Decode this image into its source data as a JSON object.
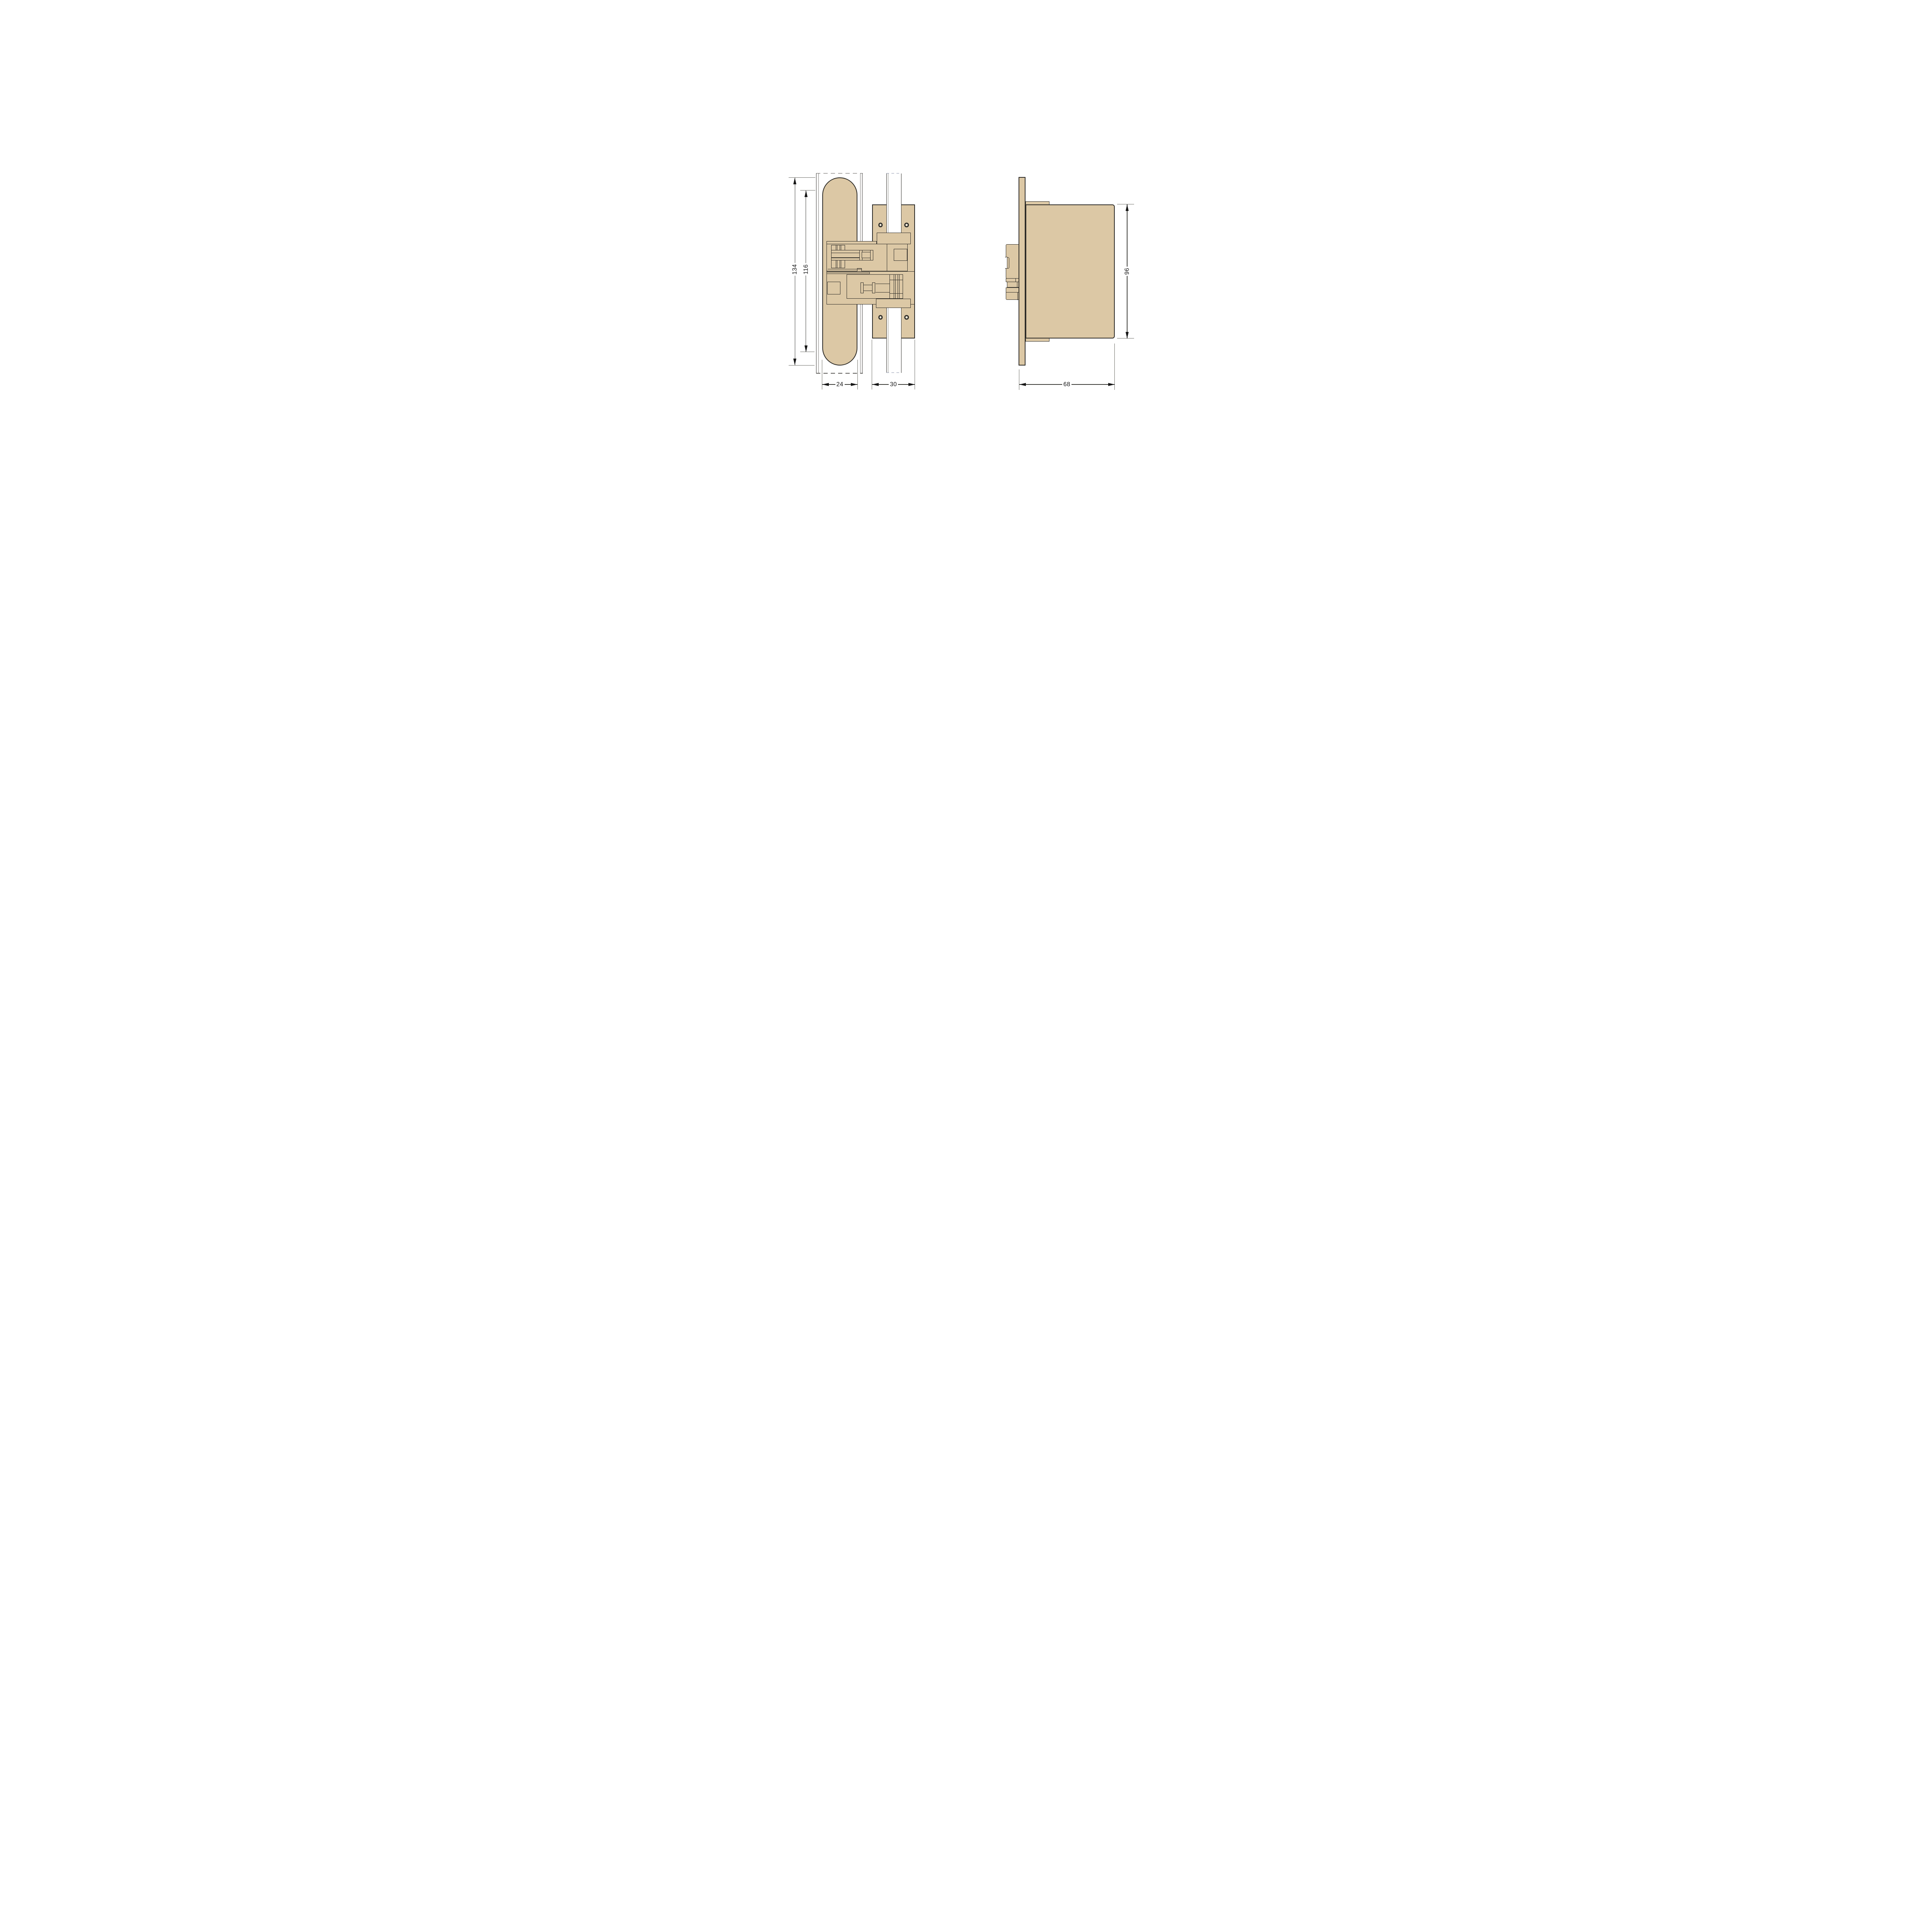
{
  "page": {
    "background_color": "#ffffff"
  },
  "drawing": {
    "outline_color": "#2e2c28",
    "body_fill_color": "#dcc8a5",
    "dimension_line_color": "#3f3f3b",
    "front_view": {
      "dimensions": {
        "overall_height": "134",
        "body_height": "116",
        "body_width": "24",
        "plate_width": "30"
      }
    },
    "side_view": {
      "dimensions": {
        "body_height": "96",
        "depth": "68"
      }
    }
  }
}
